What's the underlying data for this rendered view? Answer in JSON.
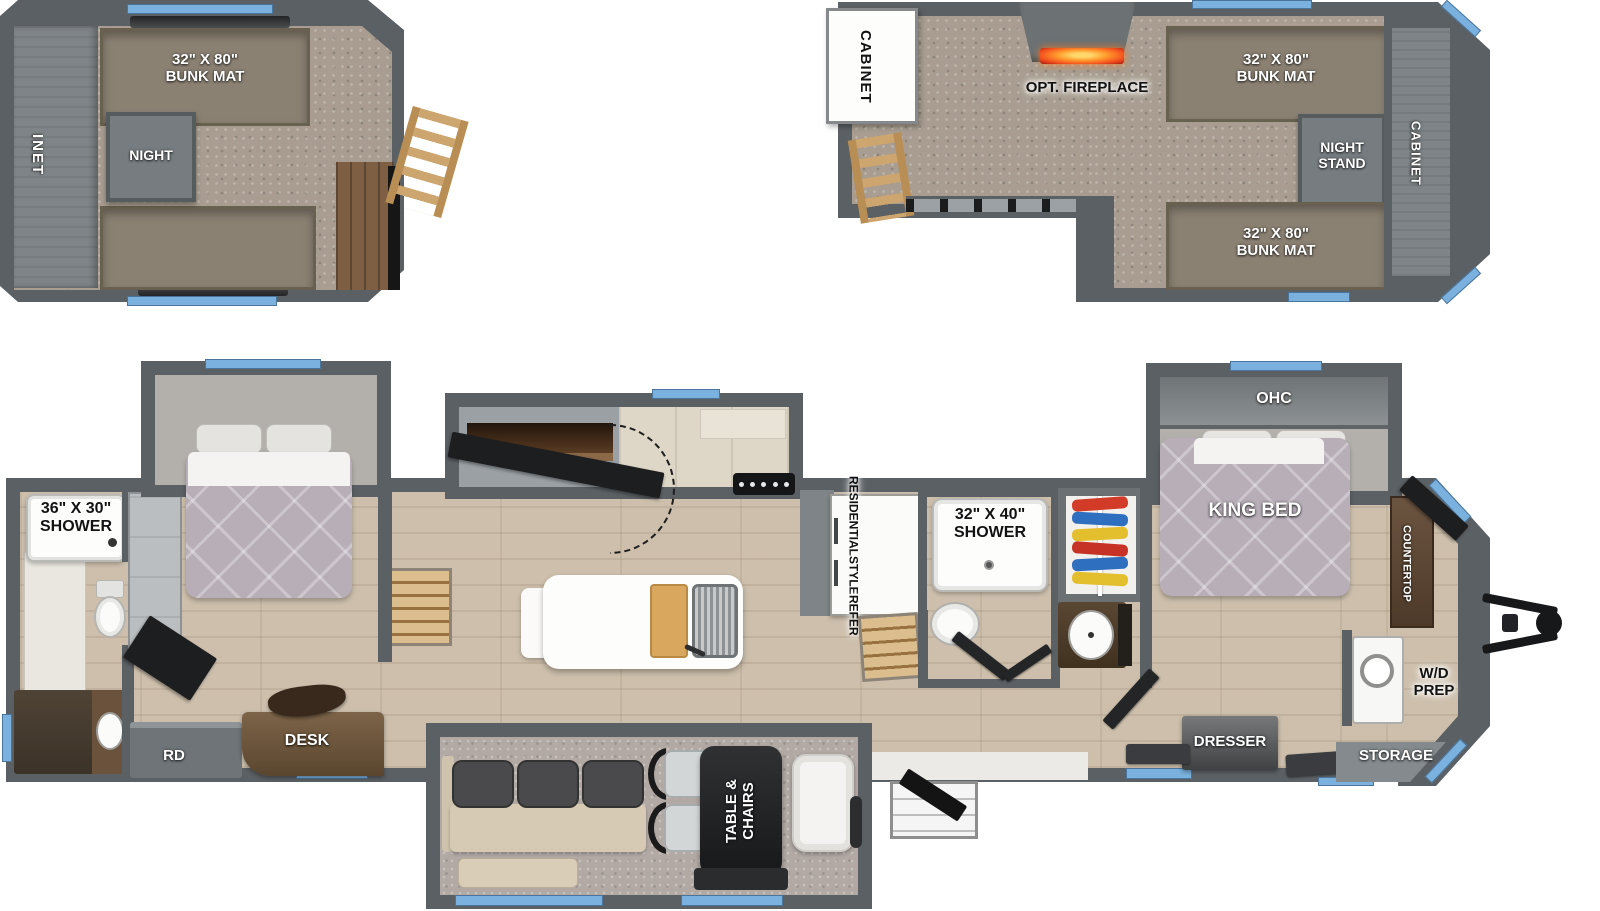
{
  "title": "RV floor plan with front and rear lofts",
  "colors": {
    "wall": "#5b6064",
    "wall_light": "#9aa0a4",
    "carpet": "#a89d90",
    "wood_floor": "#cdbfac",
    "bunk_mat": "#8b8173",
    "mattress": "#b7aeb8",
    "window_blue": "#7ab1de",
    "ladder_wood": "#cda56e",
    "desk_wood": "#6b523a",
    "flame_orange": "#ff7a1a"
  },
  "rear_loft": {
    "cabinet": "INET",
    "bunk_top": [
      "32\" X 80\"",
      "BUNK MAT"
    ],
    "nightstand": "NIGHT"
  },
  "front_loft": {
    "cabinet_left": "CABINET",
    "fireplace": "OPT. FIREPLACE",
    "bunk_top": [
      "32\" X 80\"",
      "BUNK MAT"
    ],
    "nightstand": [
      "NIGHT",
      "STAND"
    ],
    "bunk_bottom": [
      "32\" X 80\"",
      "BUNK MAT"
    ],
    "cabinet_front": "CABINET"
  },
  "main": {
    "rear_bath_shower": [
      "36\" X 30\"",
      "SHOWER"
    ],
    "rd": "RD",
    "desk": "DESK",
    "table": [
      "TABLE &",
      "CHAIRS"
    ],
    "refer": [
      "RESIDENTIAL",
      "STYLE",
      "REFER"
    ],
    "mid_shower": [
      "32\" X 40\"",
      "SHOWER"
    ],
    "ohc": "OHC",
    "king_bed": "KING BED",
    "countertop": "COUNTERTOP",
    "wd": [
      "W/D",
      "PREP"
    ],
    "dresser": "DRESSER",
    "storage": "STORAGE"
  }
}
